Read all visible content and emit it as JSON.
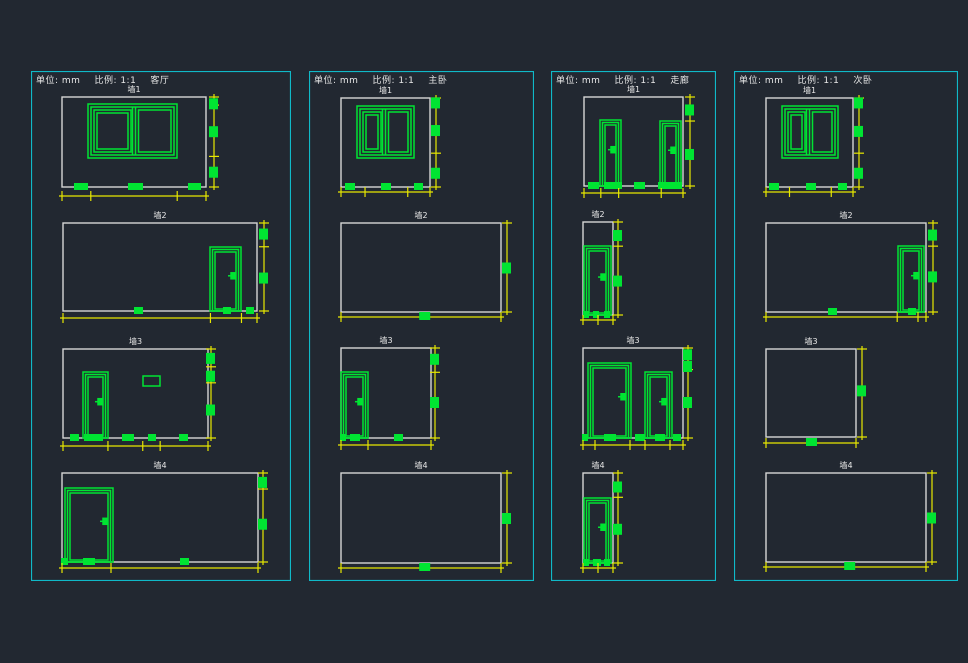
{
  "colors": {
    "background": "#222831",
    "panel_border": "#10b9c8",
    "wall": "#d6d6d6",
    "green": "#00e432",
    "yellow": "#e8e800",
    "text": "#e8e8e8"
  },
  "header": {
    "unit_label": "单位: mm",
    "scale_label": "比例: 1:1"
  },
  "panels": [
    {
      "room": "客厅",
      "x": 31,
      "y": 71,
      "w": 260,
      "h": 510,
      "walls": [
        {
          "label": "墙1",
          "rect": [
            31,
            26,
            144,
            90
          ],
          "windows": [
            {
              "r": [
                57,
                33,
                89,
                54
              ],
              "divider": 103
            }
          ],
          "doors": [],
          "vents": [],
          "bottom_squares": [
            [
              43,
              14
            ],
            [
              97,
              15
            ],
            [
              157,
              13
            ]
          ],
          "rdim": {
            "x": 183,
            "squares": [
              0.07,
              0.38,
              0.83
            ],
            "ticks": [
              0,
              0.09,
              0.66,
              1
            ]
          },
          "bdim": {
            "y": 125,
            "squares": [],
            "ticks": [
              0,
              0.2,
              0.8,
              1
            ]
          }
        },
        {
          "label": "墙2",
          "rect": [
            32,
            152,
            194,
            88
          ],
          "windows": [],
          "doors": [
            {
              "r": [
                179,
                176,
                31,
                64
              ]
            }
          ],
          "vents": [],
          "bottom_squares": [
            [
              103,
              9
            ],
            [
              192,
              8
            ],
            [
              215,
              8
            ]
          ],
          "rdim": {
            "x": 233,
            "squares": [
              0.12,
              0.62
            ],
            "ticks": [
              0,
              0.27,
              1
            ]
          },
          "bdim": {
            "y": 247,
            "squares": [],
            "ticks": [
              0,
              0.76,
              0.92,
              1
            ]
          }
        },
        {
          "label": "墙3",
          "rect": [
            32,
            278,
            145,
            89
          ],
          "windows": [],
          "doors": [
            {
              "r": [
                52,
                301,
                25,
                66
              ]
            }
          ],
          "vents": [
            [
              112,
              305,
              17,
              10
            ]
          ],
          "bottom_squares": [
            [
              39,
              9
            ],
            [
              53,
              19
            ],
            [
              91,
              12
            ],
            [
              117,
              8
            ],
            [
              148,
              9
            ]
          ],
          "rdim": {
            "x": 180,
            "squares": [
              0.1,
              0.3,
              0.68
            ],
            "ticks": [
              0,
              0.2,
              0.38,
              1
            ]
          },
          "bdim": {
            "y": 375,
            "squares": [],
            "ticks": [
              0,
              0.31,
              0.55,
              0.67,
              1
            ]
          }
        },
        {
          "label": "墙4",
          "rect": [
            31,
            402,
            196,
            89
          ],
          "windows": [],
          "doors": [
            {
              "r": [
                34,
                417,
                48,
                74
              ]
            }
          ],
          "vents": [],
          "bottom_squares": [
            [
              30,
              7
            ],
            [
              52,
              12
            ],
            [
              149,
              9
            ]
          ],
          "rdim": {
            "x": 232,
            "squares": [
              0.1,
              0.57
            ],
            "ticks": [
              0,
              0.18,
              1
            ]
          },
          "bdim": {
            "y": 497,
            "squares": [],
            "ticks": [
              0,
              0.25,
              1
            ]
          }
        }
      ]
    },
    {
      "room": "主卧",
      "x": 309,
      "y": 71,
      "w": 225,
      "h": 510,
      "walls": [
        {
          "label": "墙1",
          "rect": [
            32,
            27,
            89,
            89
          ],
          "windows": [
            {
              "r": [
                48,
                35,
                57,
                52
              ],
              "divider": 75
            }
          ],
          "doors": [],
          "vents": [],
          "bottom_squares": [
            [
              36,
              10
            ],
            [
              72,
              10
            ],
            [
              105,
              9
            ]
          ],
          "rdim": {
            "x": 127,
            "squares": [
              0.05,
              0.36,
              0.84
            ],
            "ticks": [
              0,
              0.62,
              1
            ]
          },
          "bdim": {
            "y": 121,
            "squares": [],
            "ticks": [
              0,
              0.27,
              0.75,
              1
            ]
          }
        },
        {
          "label": "墙2",
          "rect": [
            32,
            152,
            160,
            89
          ],
          "windows": [],
          "doors": [],
          "vents": [],
          "bottom_squares": [],
          "rdim": {
            "x": 198,
            "squares": [
              0.5
            ],
            "ticks": [
              0,
              1
            ]
          },
          "bdim": {
            "y": 246,
            "squares": [
              0.52
            ],
            "ticks": [
              0,
              1
            ]
          }
        },
        {
          "label": "墙3",
          "rect": [
            32,
            277,
            90,
            90
          ],
          "windows": [],
          "doors": [
            {
              "r": [
                32,
                301,
                27,
                66
              ]
            }
          ],
          "vents": [],
          "bottom_squares": [
            [
              31,
              6
            ],
            [
              41,
              10
            ],
            [
              85,
              9
            ]
          ],
          "rdim": {
            "x": 126,
            "squares": [
              0.12,
              0.6
            ],
            "ticks": [
              0,
              0.27,
              1
            ]
          },
          "bdim": {
            "y": 374,
            "squares": [],
            "ticks": [
              0,
              0.3,
              1
            ]
          }
        },
        {
          "label": "墙4",
          "rect": [
            32,
            402,
            160,
            90
          ],
          "windows": [],
          "doors": [],
          "vents": [],
          "bottom_squares": [],
          "rdim": {
            "x": 198,
            "squares": [
              0.5
            ],
            "ticks": [
              0,
              1
            ]
          },
          "bdim": {
            "y": 497,
            "squares": [
              0.52
            ],
            "ticks": [
              0,
              1
            ]
          }
        }
      ]
    },
    {
      "room": "走廊",
      "x": 551,
      "y": 71,
      "w": 165,
      "h": 510,
      "walls": [
        {
          "label": "墙1",
          "rect": [
            33,
            26,
            99,
            89
          ],
          "windows": [],
          "doors": [
            {
              "r": [
                49,
                49,
                21,
                66
              ]
            },
            {
              "r": [
                109,
                50,
                21,
                65
              ]
            }
          ],
          "vents": [],
          "bottom_squares": [
            [
              37,
              11
            ],
            [
              53,
              18
            ],
            [
              83,
              11
            ],
            [
              107,
              24
            ]
          ],
          "rdim": {
            "x": 139,
            "squares": [
              0.14,
              0.64
            ],
            "ticks": [
              0,
              0.27,
              1
            ]
          },
          "bdim": {
            "y": 122,
            "squares": [],
            "ticks": [
              0,
              0.17,
              0.35,
              0.78,
              1
            ]
          }
        },
        {
          "label": "墙2",
          "rect": [
            32,
            151,
            30,
            93
          ],
          "windows": [],
          "doors": [
            {
              "r": [
                33,
                175,
                27,
                69
              ]
            }
          ],
          "vents": [],
          "bottom_squares": [
            [
              32,
              6
            ],
            [
              42,
              6
            ],
            [
              53,
              6
            ]
          ],
          "rdim": {
            "x": 67,
            "squares": [
              0.14,
              0.63
            ],
            "ticks": [
              0,
              0.26,
              1
            ]
          },
          "bdim": {
            "y": 249,
            "squares": [],
            "ticks": [
              0,
              0.5,
              1
            ]
          }
        },
        {
          "label": "墙3",
          "rect": [
            32,
            277,
            100,
            90
          ],
          "windows": [],
          "doors": [
            {
              "r": [
                37,
                292,
                43,
                75
              ]
            },
            {
              "r": [
                94,
                301,
                27,
                66
              ]
            }
          ],
          "vents": [],
          "bottom_squares": [
            [
              31,
              6
            ],
            [
              53,
              12
            ],
            [
              84,
              10
            ],
            [
              104,
              10
            ],
            [
              122,
              8
            ]
          ],
          "rdim": {
            "x": 137,
            "squares": [
              0.07,
              0.2,
              0.6
            ],
            "ticks": [
              0,
              0.24,
              1
            ]
          },
          "bdim": {
            "y": 374,
            "squares": [],
            "ticks": [
              0,
              0.12,
              0.47,
              0.62,
              0.87,
              1
            ]
          }
        },
        {
          "label": "墙4",
          "rect": [
            32,
            402,
            30,
            90
          ],
          "windows": [],
          "doors": [
            {
              "r": [
                33,
                427,
                27,
                65
              ]
            }
          ],
          "vents": [],
          "bottom_squares": [
            [
              32,
              6
            ],
            [
              42,
              8
            ],
            [
              53,
              6
            ]
          ],
          "rdim": {
            "x": 67,
            "squares": [
              0.15,
              0.62
            ],
            "ticks": [
              0,
              0.27,
              1
            ]
          },
          "bdim": {
            "y": 497,
            "squares": [],
            "ticks": [
              0,
              0.5,
              1
            ]
          }
        }
      ]
    },
    {
      "room": "次卧",
      "x": 734,
      "y": 71,
      "w": 224,
      "h": 510,
      "walls": [
        {
          "label": "墙1",
          "rect": [
            32,
            27,
            87,
            89
          ],
          "windows": [
            {
              "r": [
                48,
                35,
                56,
                52
              ],
              "divider": 74
            }
          ],
          "doors": [],
          "vents": [],
          "bottom_squares": [
            [
              35,
              10
            ],
            [
              72,
              10
            ],
            [
              104,
              9
            ]
          ],
          "rdim": {
            "x": 125,
            "squares": [
              0.05,
              0.37,
              0.84
            ],
            "ticks": [
              0,
              0.62,
              1
            ]
          },
          "bdim": {
            "y": 121,
            "squares": [],
            "ticks": [
              0,
              0.27,
              0.75,
              1
            ]
          }
        },
        {
          "label": "墙2",
          "rect": [
            32,
            152,
            160,
            89
          ],
          "windows": [],
          "doors": [
            {
              "r": [
                164,
                175,
                26,
                66
              ]
            }
          ],
          "vents": [],
          "bottom_squares": [
            [
              94,
              9
            ],
            [
              174,
              8
            ]
          ],
          "rdim": {
            "x": 199,
            "squares": [
              0.13,
              0.6
            ],
            "ticks": [
              0,
              0.26,
              1
            ]
          },
          "bdim": {
            "y": 246,
            "squares": [],
            "ticks": [
              0,
              0.82,
              0.95,
              1
            ]
          }
        },
        {
          "label": "墙3",
          "rect": [
            32,
            278,
            90,
            88
          ],
          "windows": [],
          "doors": [],
          "vents": [],
          "bottom_squares": [],
          "rdim": {
            "x": 128,
            "squares": [
              0.47
            ],
            "ticks": [
              0,
              1
            ]
          },
          "bdim": {
            "y": 372,
            "squares": [
              0.5
            ],
            "ticks": [
              0,
              1
            ]
          }
        },
        {
          "label": "墙4",
          "rect": [
            32,
            402,
            160,
            89
          ],
          "windows": [],
          "doors": [],
          "vents": [],
          "bottom_squares": [],
          "rdim": {
            "x": 198,
            "squares": [
              0.5
            ],
            "ticks": [
              0,
              1
            ]
          },
          "bdim": {
            "y": 496,
            "squares": [
              0.52
            ],
            "ticks": [
              0,
              1
            ]
          }
        }
      ]
    }
  ]
}
